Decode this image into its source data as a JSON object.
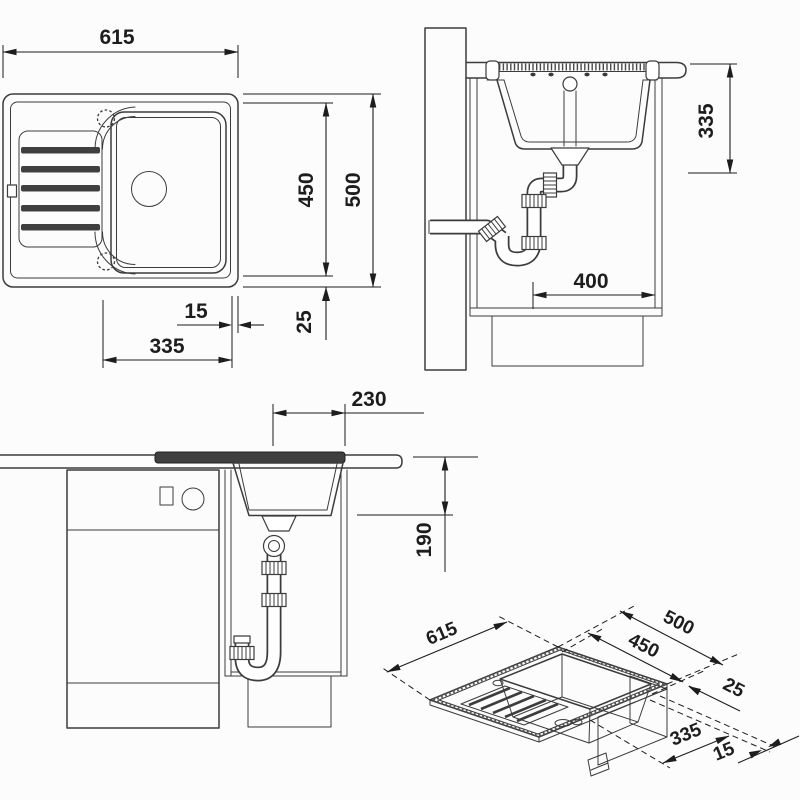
{
  "colors": {
    "line": "#3c3c3c",
    "dim": "#1d1d1d",
    "dark": "#3f3f3f",
    "bg": "#fcfcfc"
  },
  "views": {
    "top": {
      "dims": {
        "width": "615",
        "usable_depth": "450",
        "total_depth": "500",
        "right_rim": "15",
        "bowl_span": "335",
        "bottom_rim": "25"
      }
    },
    "side": {
      "dims": {
        "depth_below_worktop": "335",
        "trap_clearance": "400"
      }
    },
    "front": {
      "dims": {
        "trap_offset": "230",
        "bowl_depth": "190"
      }
    },
    "iso": {
      "dims": {
        "width": "615",
        "total_depth": "500",
        "usable_depth": "450",
        "rim": "25",
        "bowl_span": "335",
        "right_rim": "15"
      }
    }
  }
}
